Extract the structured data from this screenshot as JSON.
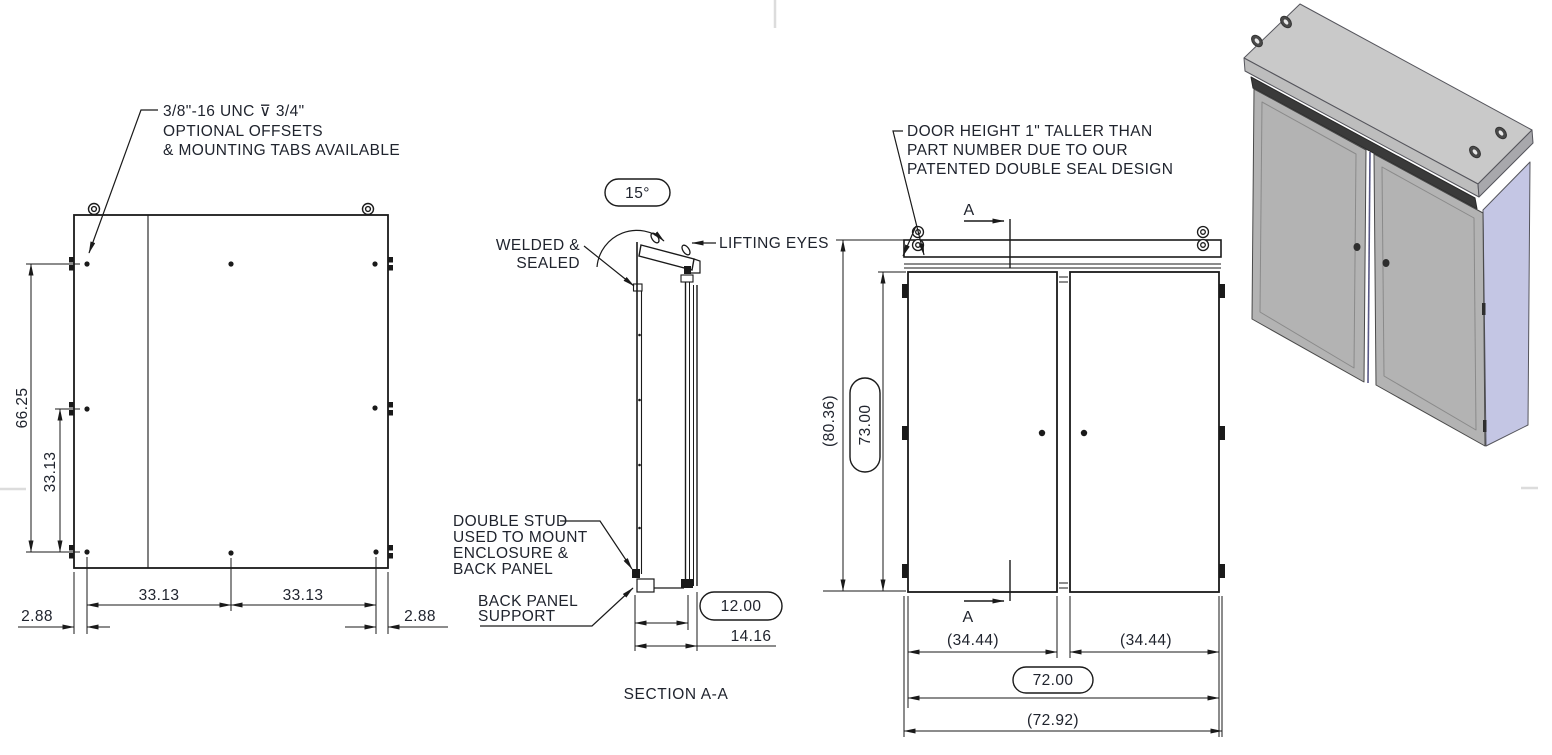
{
  "colors": {
    "line": "#1a1a1a",
    "text": "#20242e",
    "iso_top": "#c9c9c9",
    "iso_door": "#b3b3b3",
    "iso_side": "#c4c6e4",
    "iso_seal": "#3a3a3a",
    "sheet_mark": "#dcdcdc"
  },
  "rear_view": {
    "note": {
      "line1": "3/8\"-16 UNC  ⊽  3/4\"",
      "line2": "OPTIONAL OFFSETS",
      "line3": "& MOUNTING TABS AVAILABLE"
    },
    "dims": {
      "height_outer": "66.25",
      "height_inner": "33.13",
      "width_left": "33.13",
      "width_right": "33.13",
      "offset_left": "2.88",
      "offset_right": "2.88"
    }
  },
  "section_view": {
    "caption": "SECTION A-A",
    "angle_dim": "15°",
    "welded_label": {
      "line1": "WELDED &",
      "line2": "SEALED"
    },
    "lifting_eyes_label": "LIFTING EYES",
    "double_stud_label": {
      "line1": "DOUBLE STUD",
      "line2": "USED TO MOUNT",
      "line3": "ENCLOSURE &",
      "line4": "BACK PANEL"
    },
    "back_panel_label": {
      "line1": "BACK PANEL",
      "line2": "SUPPORT"
    },
    "dims": {
      "depth_inner": "12.00",
      "depth_overall": "14.16"
    }
  },
  "front_view": {
    "note": {
      "line1": "DOOR HEIGHT 1\" TALLER THAN",
      "line2": "PART NUMBER DUE TO OUR",
      "line3": "PATENTED DOUBLE SEAL DESIGN"
    },
    "section_marker_top": "A",
    "section_marker_bottom": "A",
    "dims": {
      "height_overall": "(80.36)",
      "door_height": "73.00",
      "door_width_left": "(34.44)",
      "door_width_right": "(34.44)",
      "width": "72.00",
      "width_overall": "(72.92)"
    }
  }
}
